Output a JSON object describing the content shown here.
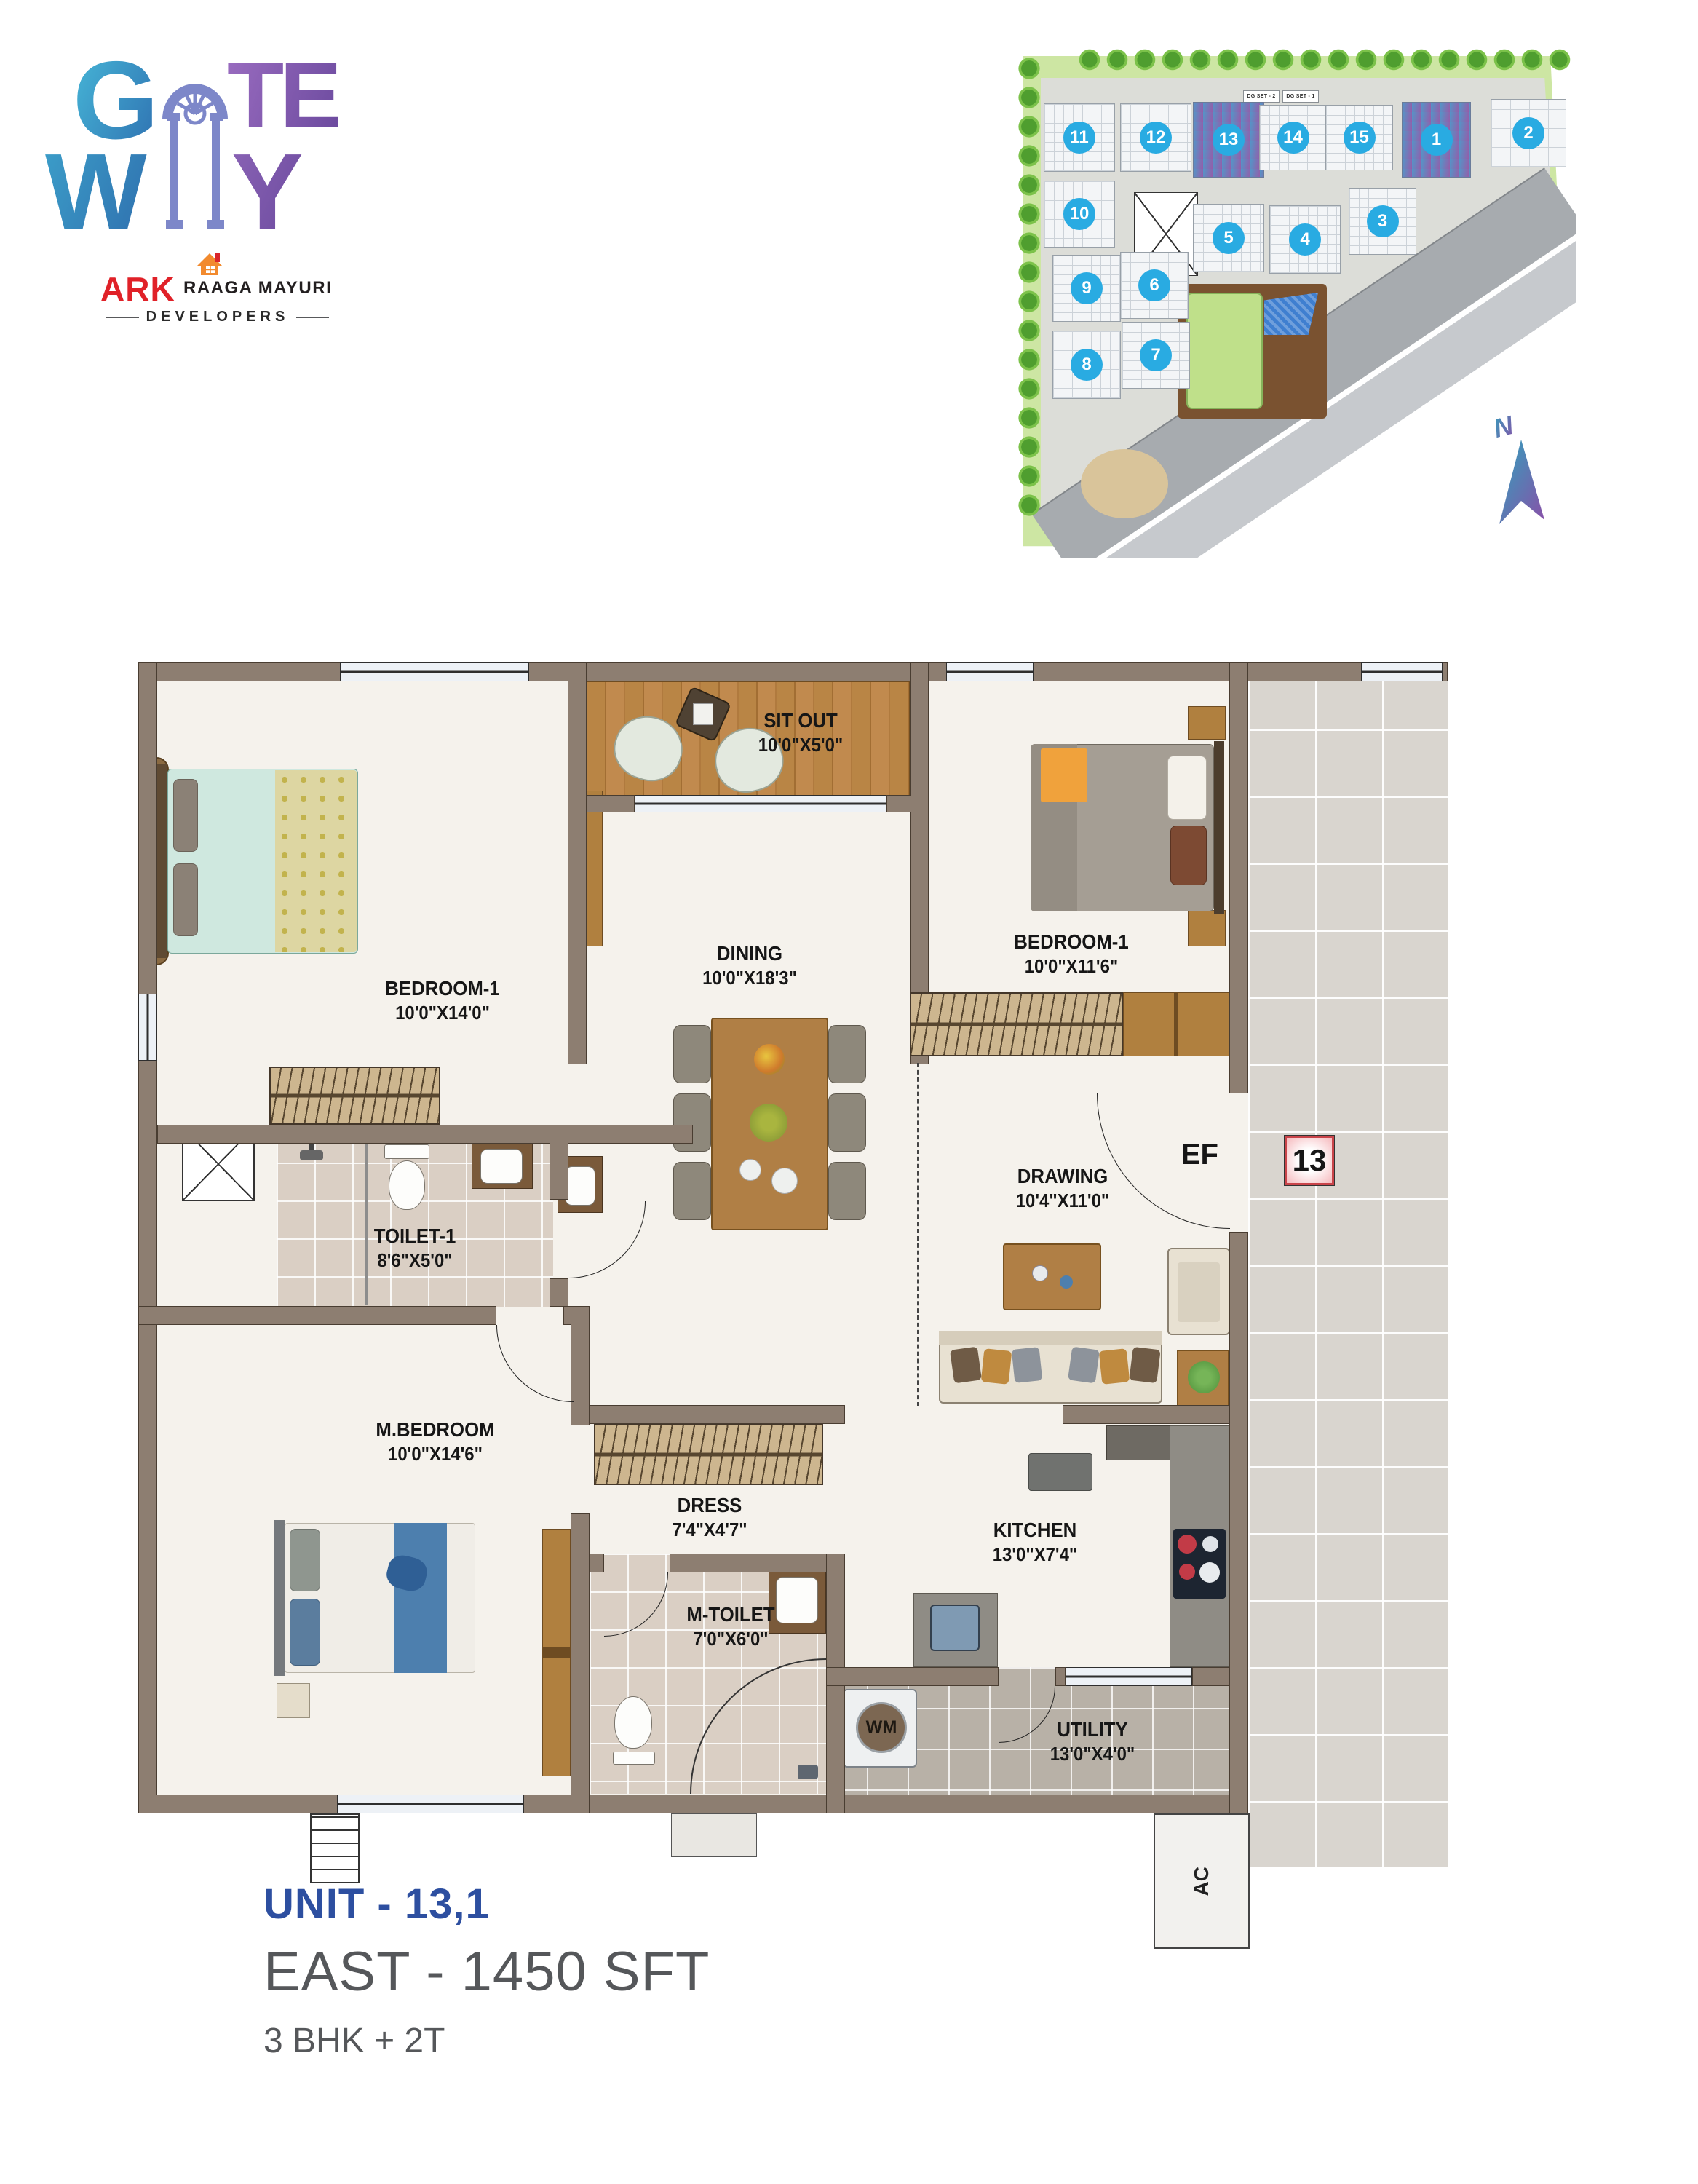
{
  "logo": {
    "brand": {
      "g": "G",
      "te": "TE",
      "w": "W",
      "y": "Y"
    },
    "developer": {
      "abbr": "ARK",
      "name": "RAAGA MAYURI",
      "division": "DEVELOPERS"
    }
  },
  "site_plan": {
    "dg_set_labels": [
      "DG SET - 2",
      "DG SET - 1"
    ],
    "north_label": "N",
    "blocks": [
      {
        "label": "11",
        "highlighted": false
      },
      {
        "label": "12",
        "highlighted": false
      },
      {
        "label": "13",
        "highlighted": true
      },
      {
        "label": "14",
        "highlighted": false
      },
      {
        "label": "15",
        "highlighted": false
      },
      {
        "label": "1",
        "highlighted": true
      },
      {
        "label": "2",
        "highlighted": false
      },
      {
        "label": "10",
        "highlighted": false
      },
      {
        "label": "5",
        "highlighted": false
      },
      {
        "label": "4",
        "highlighted": false
      },
      {
        "label": "3",
        "highlighted": false
      },
      {
        "label": "9",
        "highlighted": false
      },
      {
        "label": "6",
        "highlighted": false
      },
      {
        "label": "8",
        "highlighted": false
      },
      {
        "label": "7",
        "highlighted": false
      }
    ]
  },
  "floor_plan": {
    "rooms": [
      {
        "name": "SIT OUT",
        "dims": "10'0\"X5'0\""
      },
      {
        "name": "BEDROOM-1",
        "dims": "10'0\"X14'0\""
      },
      {
        "name": "DINING",
        "dims": "10'0\"X18'3\""
      },
      {
        "name": "BEDROOM-1",
        "dims": "10'0\"X11'6\""
      },
      {
        "name": "TOILET-1",
        "dims": "8'6\"X5'0\""
      },
      {
        "name": "DRAWING",
        "dims": "10'4\"X11'0\""
      },
      {
        "name": "M.BEDROOM",
        "dims": "10'0\"X14'6\""
      },
      {
        "name": "DRESS",
        "dims": "7'4\"X4'7\""
      },
      {
        "name": "M-TOILET",
        "dims": "7'0\"X6'0\""
      },
      {
        "name": "KITCHEN",
        "dims": "13'0\"X7'4\""
      },
      {
        "name": "UTILITY",
        "dims": "13'0\"X4'0\""
      }
    ],
    "markers": {
      "entry_label": "EF",
      "unit_number": "13",
      "ac_label": "AC",
      "wm_label": "WM"
    }
  },
  "unit_info": {
    "unit": "UNIT - 13,1",
    "orientation_area": "EAST - 1450 SFT",
    "configuration": "3 BHK + 2T"
  },
  "colors": {
    "accent_blue": "#2d4fa0",
    "text_gray": "#55575a",
    "wall_taupe": "#8d7e71",
    "block_cyan": "#29abe2",
    "badge_red": "#c9444a",
    "highlight_gradient_start": "#4e92c6",
    "highlight_gradient_end": "#9257a6"
  }
}
